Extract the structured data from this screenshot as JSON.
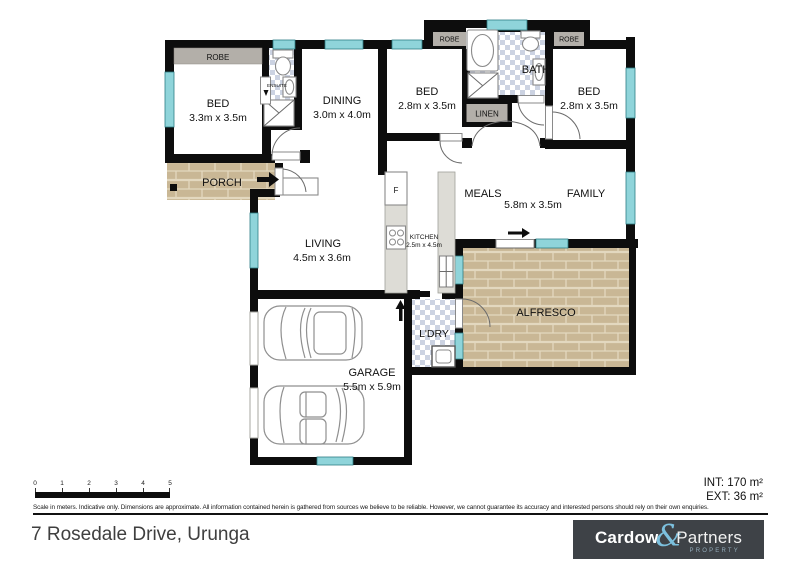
{
  "plan": {
    "rooms": {
      "bed1": {
        "label": "BED",
        "dims": "3.3m x 3.5m"
      },
      "dining": {
        "label": "DINING",
        "dims": "3.0m x 4.0m"
      },
      "bed2": {
        "label": "BED",
        "dims": "2.8m x 3.5m"
      },
      "bed3": {
        "label": "BED",
        "dims": "2.8m x 3.5m"
      },
      "bath": {
        "label": "BATH"
      },
      "ensuite": {
        "label": "ENSUITE"
      },
      "robe_bed1": {
        "label": "ROBE"
      },
      "robe_bed2": {
        "label": "ROBE"
      },
      "robe_bed3": {
        "label": "ROBE"
      },
      "linen": {
        "label": "LINEN"
      },
      "porch": {
        "label": "PORCH"
      },
      "living": {
        "label": "LIVING",
        "dims": "4.5m x 3.6m"
      },
      "kitchen": {
        "label": "KITCHEN",
        "dims": "2.5m x 4.5m",
        "fridge": "F"
      },
      "meals": {
        "label": "MEALS"
      },
      "family": {
        "label": "FAMILY"
      },
      "meals_family_dims": "5.8m x 3.5m",
      "alfresco": {
        "label": "ALFRESCO"
      },
      "laundry": {
        "label": "L'DRY"
      },
      "garage": {
        "label": "GARAGE",
        "dims": "5.5m x 5.9m"
      }
    }
  },
  "scale_bar": {
    "ticks": [
      "0",
      "1",
      "2",
      "3",
      "4",
      "5"
    ]
  },
  "disclaimer": "Scale in meters. Indicative only. Dimensions are approximate. All information contained herein is gathered from sources we believe to be reliable. However, we cannot guarantee its accuracy and interested persons should rely on their own enquiries.",
  "footer": {
    "address": "7 Rosedale Drive, Urunga",
    "int_area": "INT: 170 m²",
    "ext_area": "EXT: 36 m²"
  },
  "logo": {
    "word1": "Cardow",
    "ampersand": "&",
    "word2": "Partners",
    "tagline": "PROPERTY"
  },
  "colors": {
    "wall": "#0d0d0d",
    "window": "#8fd4da",
    "brick": "#c9b795",
    "tile": "#ccd3e2",
    "logo_bg": "#3e4247",
    "logo_accent": "#7cc0de"
  }
}
